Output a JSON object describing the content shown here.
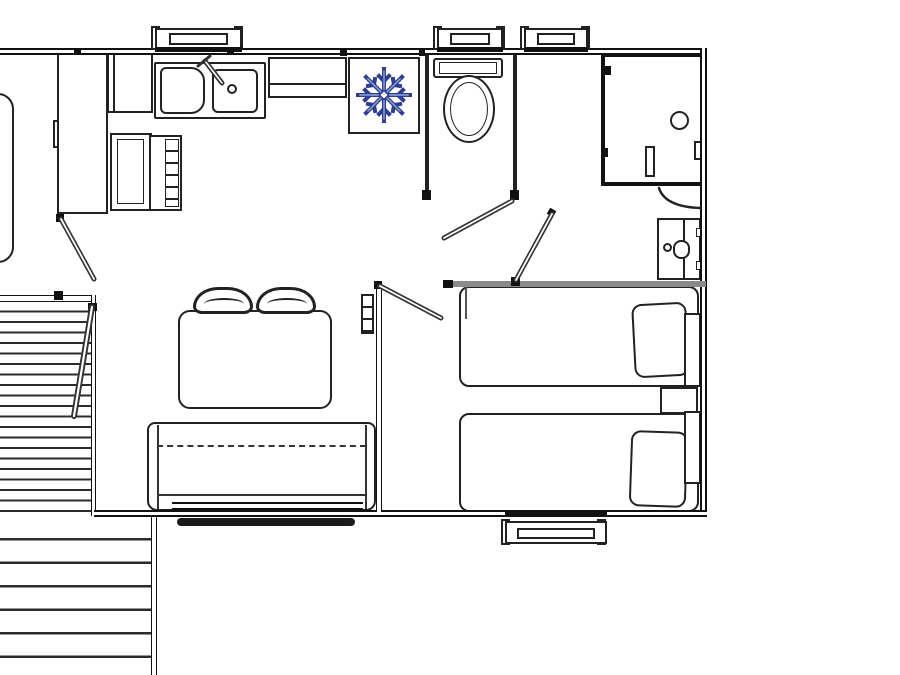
{
  "document": {
    "type": "floor-plan drawing",
    "subject": "two-bedroom mobile home / cabin layout with front deck",
    "visible_text": "none"
  },
  "colors": {
    "background": "#ffffff",
    "linework": "#222222",
    "thick_wall": "#111111",
    "partition_wall_gray": "#8a8a8a",
    "snowflake_outline": "#2e3d91",
    "snowflake_highlight": "#8fa6d6"
  },
  "rooms": [
    {
      "name": "kitchen",
      "position": "top-left"
    },
    {
      "name": "wc",
      "position": "top-center"
    },
    {
      "name": "shower-room",
      "position": "top-right"
    },
    {
      "name": "living-dining",
      "position": "center-left"
    },
    {
      "name": "twin-bedroom",
      "position": "right"
    },
    {
      "name": "cut-off-room",
      "position": "left-edge, partially visible"
    },
    {
      "name": "deck",
      "position": "bottom-left, slatted boards"
    }
  ],
  "fixtures": [
    "wardrobe",
    "kitchen-upper-cabinet",
    "double-sink-with-faucet",
    "counter-shelf",
    "lower-cabinet",
    "oven-with-grill",
    "fridge-freezer-with-snowflake-symbol",
    "toilet-with-cistern",
    "shower-enclosure-with-drain",
    "washbasin-vanity",
    "dining-table",
    "chair",
    "chair",
    "sofa-bench",
    "single-bed-with-pillow",
    "single-bed-with-pillow",
    "nightstand",
    "wall-heater",
    "deck-upper-section",
    "deck-lower-section",
    "deck-brace"
  ],
  "windows": {
    "top_wall_count": 3,
    "bottom_wall_count": 1,
    "under_sofa_strip_count": 1
  },
  "doors": {
    "entry_door": 1,
    "wc_door": 1,
    "bedroom_door": 1,
    "hall_door": 1,
    "shower_screen_arc": 1
  },
  "icon": {
    "name": "snowflake-icon",
    "meaning": "fridge/freezer",
    "arms": 8
  }
}
